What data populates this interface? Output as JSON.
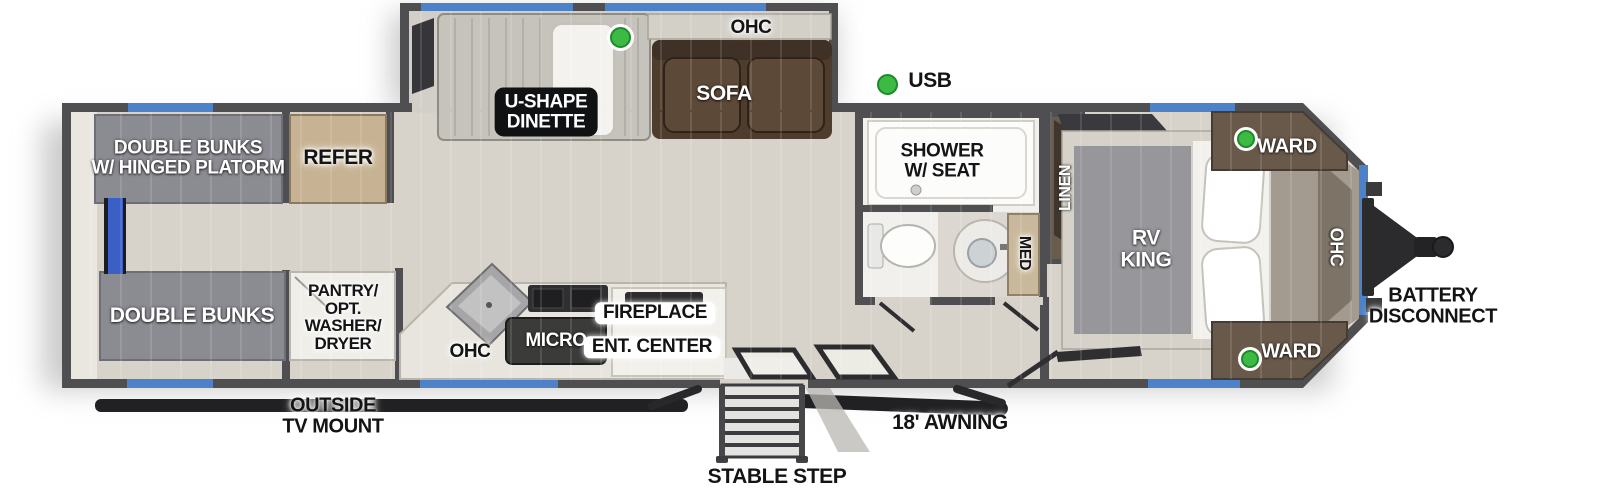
{
  "legend": {
    "usb": "USB"
  },
  "slide_out": {
    "dinette": [
      "U-SHAPE",
      "DINETTE"
    ],
    "sofa": "SOFA",
    "ohc": "OHC"
  },
  "rear_bunk_room": {
    "bunk_top": [
      "DOUBLE BUNKS",
      "W/ HINGED PLATORM"
    ],
    "bunk_bottom": "DOUBLE BUNKS",
    "refer": "REFER",
    "pantry": [
      "PANTRY/",
      "OPT.",
      "WASHER/",
      "DRYER"
    ]
  },
  "kitchen_living": {
    "ohc": "OHC",
    "micro": "MICRO",
    "fireplace": "FIREPLACE",
    "ent_center": "ENT. CENTER"
  },
  "bathroom": {
    "shower": [
      "SHOWER",
      "W/ SEAT"
    ],
    "med": "MED",
    "linen": "LINEN"
  },
  "bedroom": {
    "bed": [
      "RV",
      "KING"
    ],
    "ward_top": "WARD",
    "ward_bottom": "WARD",
    "ohc": "OHC"
  },
  "exterior": {
    "battery_disconnect": [
      "BATTERY",
      "DISCONNECT"
    ],
    "outside_tv_mount": [
      "OUTSIDE",
      "TV MOUNT"
    ],
    "stable_step": "STABLE STEP",
    "awning": "18' AWNING"
  },
  "colors": {
    "wall_gray": "#4f4f52",
    "floor_tan": "#d8d3ca",
    "window_blue": "#4e82c8",
    "ladder_blue": "#3a5fc6",
    "usb_green": "#3cba44",
    "sofa_brown": "#4e3c2d",
    "bunk_gray": "#8b8b92",
    "refer_tan": "#c7b394"
  }
}
